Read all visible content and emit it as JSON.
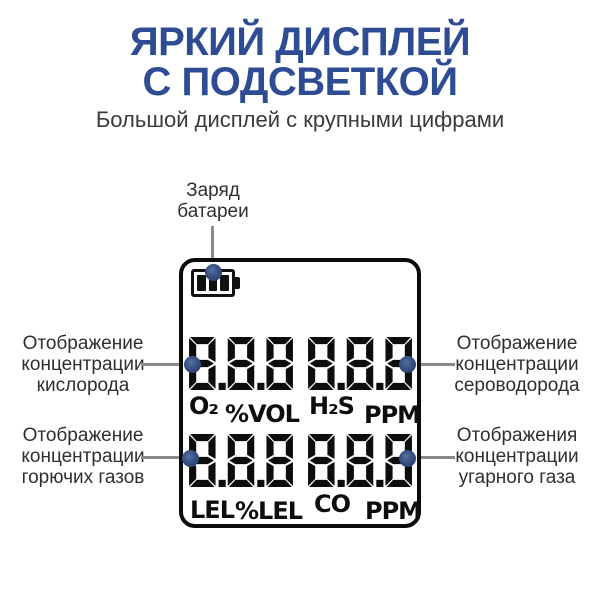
{
  "colors": {
    "background": "#ffffff",
    "title_blue": "#2d4c93",
    "label_dark": "#2f2f2f",
    "callout_line_gray": "#8a8a8a",
    "callout_dot_navy": "#2c4170",
    "display_ink_black": "#0d0d0d"
  },
  "header": {
    "title_line1": "ЯРКИЙ ДИСПЛЕЙ",
    "title_line2": "С ПОДСВЕТКОЙ",
    "subtitle": "Большой дисплей с крупными цифрами"
  },
  "callouts": {
    "battery": {
      "lines": [
        "Заряд",
        "батареи"
      ]
    },
    "left_top": {
      "lines": [
        "Отображение",
        "концентрации",
        "кислорода"
      ]
    },
    "left_bottom": {
      "lines": [
        "Отображение",
        "концентрации",
        "горючих газов"
      ]
    },
    "right_top": {
      "lines": [
        "Отображение",
        "концентрации",
        "сероводорода"
      ]
    },
    "right_bottom": {
      "lines": [
        "Отображения",
        "концентрации",
        "угарного газа"
      ]
    }
  },
  "display": {
    "battery_icon": "battery-icon",
    "battery_bars": 3,
    "readings": {
      "top_left": {
        "value": "8.8.8",
        "gas": "O₂",
        "unit": "%VOL"
      },
      "top_right": {
        "value": "8.8.8",
        "gas": "H₂S",
        "unit": "PPM"
      },
      "bottom_left": {
        "value": "8.8.8",
        "gas": "LEL",
        "unit": "%LEL"
      },
      "bottom_right": {
        "value": "8.8.8",
        "gas": "CO",
        "unit": "PPM"
      }
    }
  }
}
